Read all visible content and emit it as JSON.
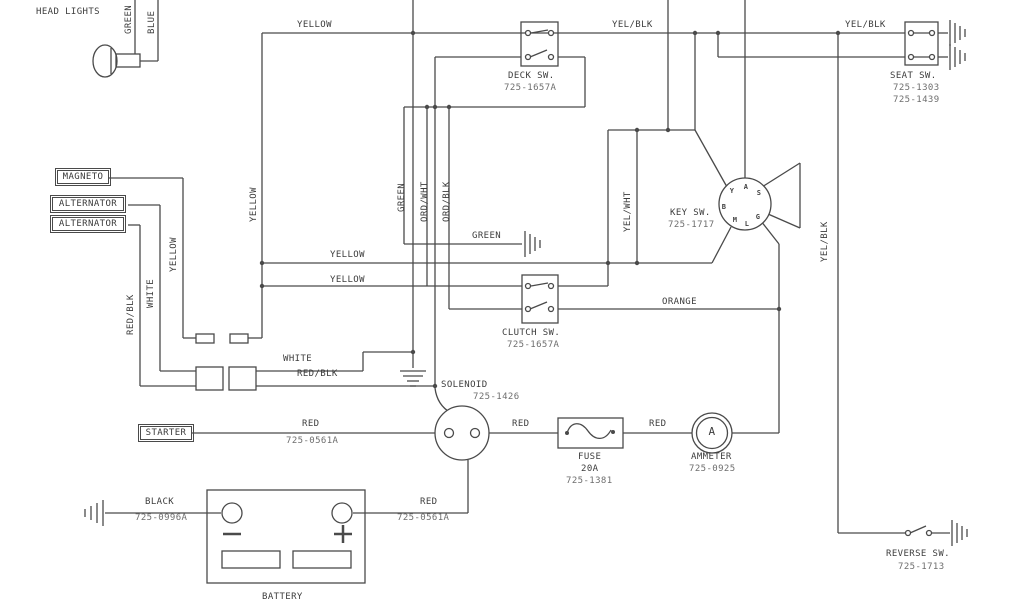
{
  "diagram": {
    "description": "Riding mower electrical wiring schematic",
    "line_color": "#4a4a4a",
    "background": "#ffffff"
  },
  "components": {
    "head_lights": {
      "label": "HEAD LIGHTS",
      "wires": [
        "GREEN",
        "BLUE"
      ]
    },
    "magneto": {
      "label": "MAGNETO",
      "wire": "YELLOW"
    },
    "alternator_1": {
      "label": "ALTERNATOR",
      "wire": "WHITE"
    },
    "alternator_2": {
      "label": "ALTERNATOR",
      "wire": "RED/BLK"
    },
    "deck_switch": {
      "label": "DECK SW.",
      "part": "725-1657A"
    },
    "seat_switch": {
      "label": "SEAT SW.",
      "parts": [
        "725-1303",
        "725-1439"
      ]
    },
    "key_switch": {
      "label": "KEY SW.",
      "part": "725-1717",
      "terminals": [
        "Y",
        "A",
        "S",
        "B",
        "M",
        "L",
        "G"
      ]
    },
    "clutch_switch": {
      "label": "CLUTCH SW.",
      "part": "725-1657A"
    },
    "solenoid": {
      "label": "SOLENOID",
      "part": "725-1426"
    },
    "fuse": {
      "label": "FUSE",
      "rating": "20A",
      "part": "725-1381"
    },
    "ammeter": {
      "label": "AMMETER",
      "part": "725-0925",
      "symbol": "A"
    },
    "starter": {
      "label": "STARTER",
      "cable": {
        "color": "RED",
        "part": "725-0561A"
      }
    },
    "battery": {
      "label": "BATTERY",
      "terminals": [
        "-",
        "+"
      ],
      "negative_cable": {
        "color": "BLACK",
        "part": "725-0996A"
      },
      "positive_cable": {
        "color": "RED",
        "part": "725-0561A"
      }
    },
    "reverse_switch": {
      "label": "REVERSE SW.",
      "part": "725-1713"
    }
  },
  "wire_colors": [
    "YELLOW",
    "YEL/BLK",
    "GREEN",
    "BLUE",
    "WHITE",
    "RED/BLK",
    "ORD/WHT",
    "ORD/BLK",
    "YEL/WHT",
    "ORANGE",
    "RED",
    "BLACK"
  ],
  "labels": [
    {
      "name": "head-lights-label",
      "text": "HEAD LIGHTS",
      "x": 36,
      "y": 7
    },
    {
      "name": "wire-green-headlight",
      "text": "GREEN",
      "x": 124,
      "y": 34,
      "rot": true
    },
    {
      "name": "wire-blue-headlight",
      "text": "BLUE",
      "x": 147,
      "y": 34,
      "rot": true
    },
    {
      "name": "wire-yellow-top",
      "text": "YELLOW",
      "x": 297,
      "y": 20
    },
    {
      "name": "wire-yelblk-top-1",
      "text": "YEL/BLK",
      "x": 612,
      "y": 20
    },
    {
      "name": "wire-yelblk-top-2",
      "text": "YEL/BLK",
      "x": 845,
      "y": 20
    },
    {
      "name": "deck-switch-label",
      "text": "DECK SW.",
      "x": 508,
      "y": 71
    },
    {
      "name": "deck-switch-part",
      "text": "725-1657A",
      "x": 504,
      "y": 83,
      "muted": true
    },
    {
      "name": "seat-switch-label",
      "text": "SEAT SW.",
      "x": 890,
      "y": 71
    },
    {
      "name": "seat-switch-part-1",
      "text": "725-1303",
      "x": 893,
      "y": 83,
      "muted": true
    },
    {
      "name": "seat-switch-part-2",
      "text": "725-1439",
      "x": 893,
      "y": 95,
      "muted": true
    },
    {
      "name": "magneto-label",
      "text": "MAGNETO",
      "x": 55,
      "y": 168,
      "boxed": true,
      "w": 44
    },
    {
      "name": "alternator-label-1",
      "text": "ALTERNATOR",
      "x": 50,
      "y": 195,
      "boxed": true,
      "w": 64
    },
    {
      "name": "alternator-label-2",
      "text": "ALTERNATOR",
      "x": 50,
      "y": 215,
      "boxed": true,
      "w": 64
    },
    {
      "name": "wire-yellow-v262",
      "text": "YELLOW",
      "x": 249,
      "y": 222,
      "rot": true
    },
    {
      "name": "wire-yellow-v183",
      "text": "YELLOW",
      "x": 169,
      "y": 272,
      "rot": true
    },
    {
      "name": "wire-white-v160",
      "text": "WHITE",
      "x": 146,
      "y": 308,
      "rot": true
    },
    {
      "name": "wire-redblk-v140",
      "text": "RED/BLK",
      "x": 126,
      "y": 335,
      "rot": true
    },
    {
      "name": "wire-green-v404",
      "text": "GREEN",
      "x": 397,
      "y": 212,
      "rot": true
    },
    {
      "name": "wire-ordwht-v427",
      "text": "ORD/WHT",
      "x": 420,
      "y": 222,
      "rot": true
    },
    {
      "name": "wire-ordblk-v449",
      "text": "ORD/BLK",
      "x": 442,
      "y": 222,
      "rot": true
    },
    {
      "name": "wire-green-ground",
      "text": "GREEN",
      "x": 472,
      "y": 231
    },
    {
      "name": "wire-yelwht-v637",
      "text": "YEL/WHT",
      "x": 623,
      "y": 232,
      "rot": true
    },
    {
      "name": "key-switch-label",
      "text": "KEY SW.",
      "x": 670,
      "y": 208
    },
    {
      "name": "key-switch-part",
      "text": "725-1717",
      "x": 668,
      "y": 220,
      "muted": true
    },
    {
      "name": "wire-yellow-h263",
      "text": "YELLOW",
      "x": 330,
      "y": 250
    },
    {
      "name": "wire-yellow-h286",
      "text": "YELLOW",
      "x": 330,
      "y": 275
    },
    {
      "name": "wire-orange",
      "text": "ORANGE",
      "x": 662,
      "y": 297
    },
    {
      "name": "clutch-switch-label",
      "text": "CLUTCH SW.",
      "x": 502,
      "y": 328
    },
    {
      "name": "clutch-switch-part",
      "text": "725-1657A",
      "x": 507,
      "y": 340,
      "muted": true
    },
    {
      "name": "wire-white-h",
      "text": "WHITE",
      "x": 283,
      "y": 354
    },
    {
      "name": "wire-redblk-h",
      "text": "RED/BLK",
      "x": 297,
      "y": 369
    },
    {
      "name": "solenoid-label",
      "text": "SOLENOID",
      "x": 441,
      "y": 380
    },
    {
      "name": "solenoid-part",
      "text": "725-1426",
      "x": 473,
      "y": 392,
      "muted": true
    },
    {
      "name": "wire-yelblk-right",
      "text": "YEL/BLK",
      "x": 820,
      "y": 262,
      "rot": true
    },
    {
      "name": "starter-label",
      "text": "STARTER",
      "x": 138,
      "y": 424,
      "boxed": true,
      "w": 44
    },
    {
      "name": "wire-red-starter",
      "text": "RED",
      "x": 302,
      "y": 419
    },
    {
      "name": "starter-cable-part",
      "text": "725-0561A",
      "x": 286,
      "y": 436,
      "muted": true
    },
    {
      "name": "wire-red-fuse",
      "text": "RED",
      "x": 512,
      "y": 419
    },
    {
      "name": "fuse-label",
      "text": "FUSE",
      "x": 578,
      "y": 452
    },
    {
      "name": "fuse-rating",
      "text": "20A",
      "x": 581,
      "y": 464
    },
    {
      "name": "fuse-part",
      "text": "725-1381",
      "x": 566,
      "y": 476,
      "muted": true
    },
    {
      "name": "wire-red-ammeter",
      "text": "RED",
      "x": 649,
      "y": 419
    },
    {
      "name": "ammeter-symbol",
      "text": "A",
      "x": 712,
      "y": 432,
      "center": true,
      "size": 11
    },
    {
      "name": "ammeter-label",
      "text": "AMMETER",
      "x": 691,
      "y": 452
    },
    {
      "name": "ammeter-part",
      "text": "725-0925",
      "x": 689,
      "y": 464,
      "muted": true
    },
    {
      "name": "wire-black",
      "text": "BLACK",
      "x": 145,
      "y": 497
    },
    {
      "name": "battery-ground-part",
      "text": "725-0996A",
      "x": 135,
      "y": 513,
      "muted": true
    },
    {
      "name": "wire-red-battery",
      "text": "RED",
      "x": 420,
      "y": 497
    },
    {
      "name": "battery-cable-part",
      "text": "725-0561A",
      "x": 397,
      "y": 513,
      "muted": true
    },
    {
      "name": "battery-label",
      "text": "BATTERY",
      "x": 262,
      "y": 592
    },
    {
      "name": "reverse-switch-label",
      "text": "REVERSE SW.",
      "x": 886,
      "y": 549
    },
    {
      "name": "reverse-switch-part",
      "text": "725-1713",
      "x": 898,
      "y": 562,
      "muted": true
    },
    {
      "name": "key-terminal-y",
      "text": "Y",
      "x": 732,
      "y": 191,
      "center": true,
      "term": true
    },
    {
      "name": "key-terminal-a",
      "text": "A",
      "x": 746,
      "y": 187,
      "center": true,
      "term": true
    },
    {
      "name": "key-terminal-s",
      "text": "S",
      "x": 759,
      "y": 193,
      "center": true,
      "term": true
    },
    {
      "name": "key-terminal-b",
      "text": "B",
      "x": 724,
      "y": 207,
      "center": true,
      "term": true
    },
    {
      "name": "key-terminal-m",
      "text": "M",
      "x": 735,
      "y": 220,
      "center": true,
      "term": true
    },
    {
      "name": "key-terminal-l",
      "text": "L",
      "x": 747,
      "y": 224,
      "center": true,
      "term": true
    },
    {
      "name": "key-terminal-g",
      "text": "G",
      "x": 758,
      "y": 217,
      "center": true,
      "term": true
    }
  ]
}
